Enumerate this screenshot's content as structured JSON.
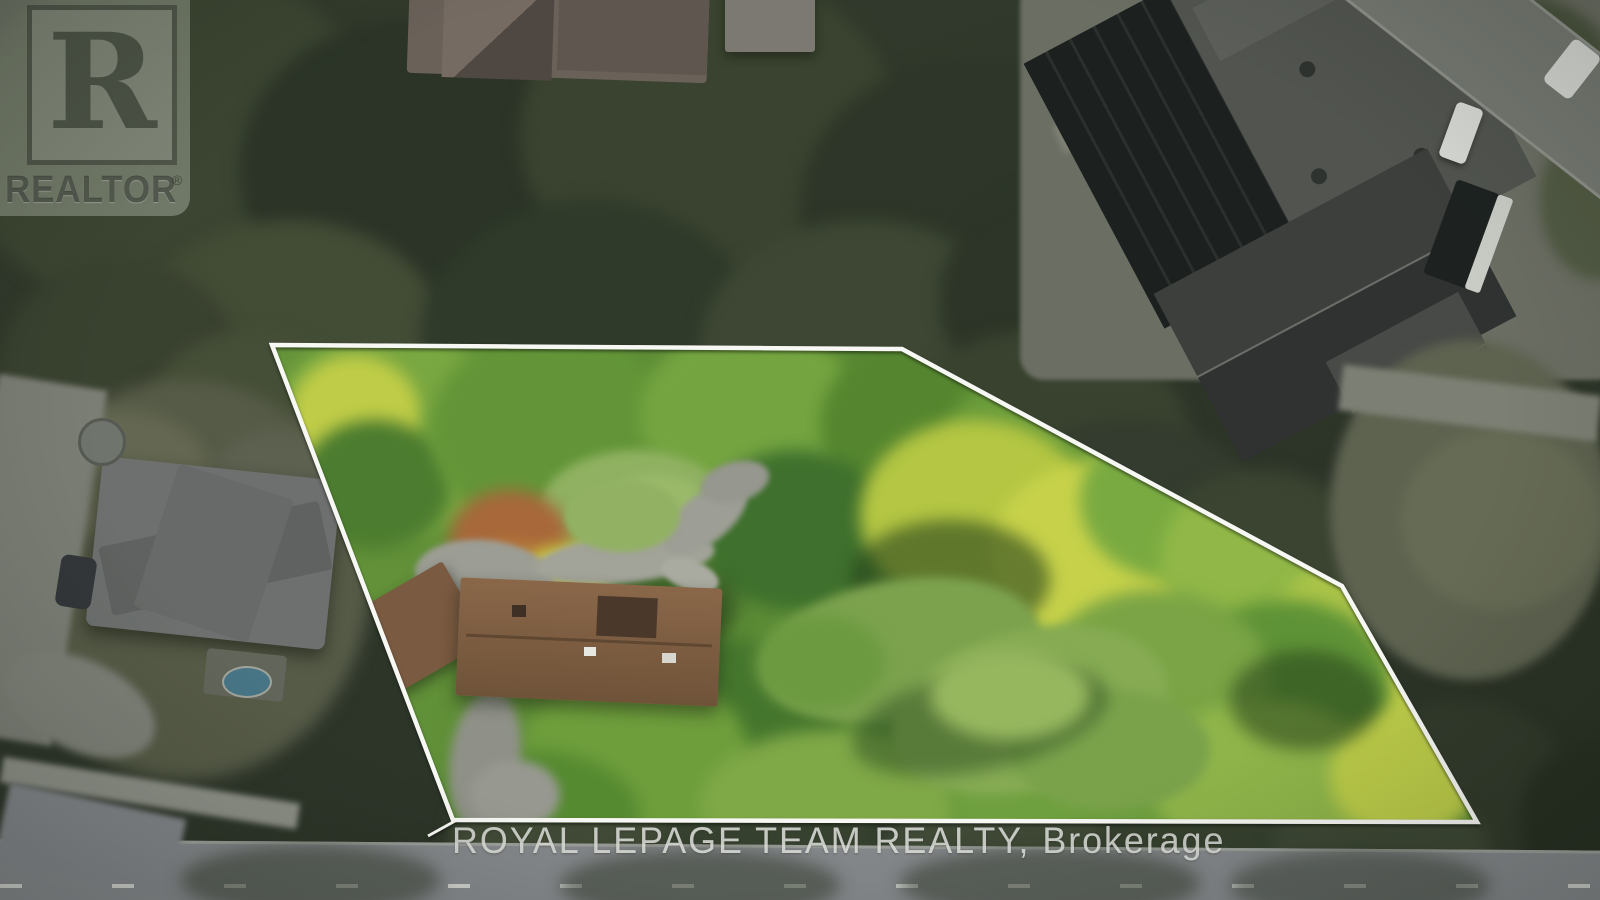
{
  "image": {
    "width": 1600,
    "height": 900,
    "kind": "aerial real-estate listing photograph"
  },
  "watermarks": {
    "realtor_logo": {
      "letter": "R",
      "label": "REALTOR",
      "registered_mark": "®"
    },
    "brokerage_line": {
      "text": "ROYAL LEPAGE TEAM REALTY, Brokerage",
      "color": "#e8e9e5"
    }
  },
  "property_boundary": {
    "stroke_color": "#f7f7f4",
    "stroke_width": 4.5,
    "points": [
      [
        272,
        345
      ],
      [
        902,
        349
      ],
      [
        1342,
        586
      ],
      [
        1477,
        822
      ],
      [
        453,
        820
      ]
    ],
    "corner_tick": [
      [
        428,
        836
      ],
      [
        455,
        821
      ]
    ]
  },
  "scene": {
    "lot_interior": {
      "label": "highlighted property lot",
      "base_color": "#5c8c36",
      "canopy_highlight_color": "#c7d24a",
      "lawn_color": "#86ab53",
      "driveway_color": "#9c9d94",
      "house_roof_color": "#7a5a41"
    },
    "surroundings": {
      "label": "dimmed neighbourhood",
      "forest_color": "#31392b",
      "road_color": "#85888b",
      "school_roof_color": "#51544f",
      "neighbor_roof_color": "#6d706e"
    }
  }
}
